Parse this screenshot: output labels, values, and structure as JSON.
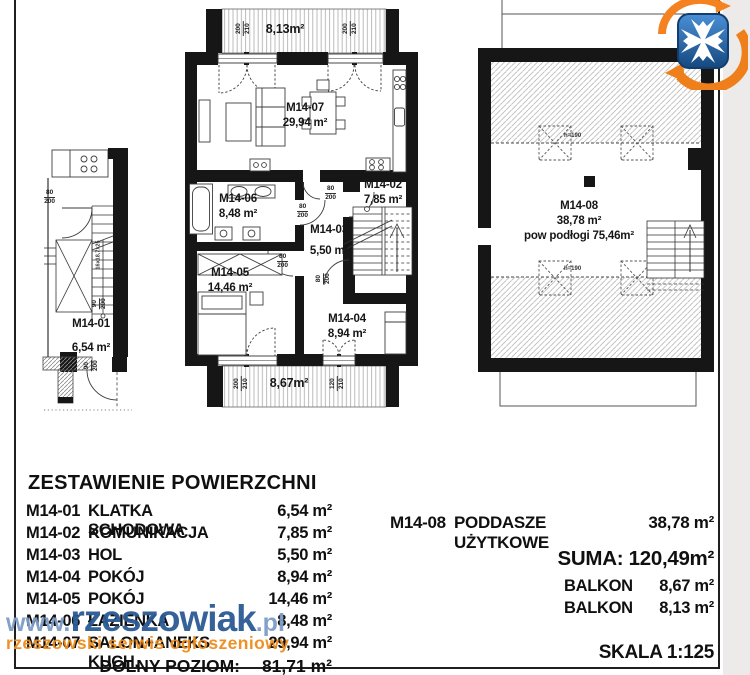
{
  "watermark": {
    "prefix": "www.",
    "brand": "rzeszowiak",
    "suffix": ".pl",
    "tagline": "rzeszowski serwis ogłoszeniowy"
  },
  "plan_lower": {
    "balcony_top_area": "8,13m²",
    "balcony_bottom_area": "8,67m²",
    "rooms": [
      {
        "id": "M14-07",
        "area": "29,94 m²"
      },
      {
        "id": "M14-06",
        "area": "8,48 m²"
      },
      {
        "id": "M14-02",
        "area": "7,85 m²"
      },
      {
        "id": "M14-03",
        "area": "5,50 m²"
      },
      {
        "id": "M14-05",
        "area": "14,46 m²"
      },
      {
        "id": "M14-04",
        "area": "8,94 m²"
      }
    ]
  },
  "plan_stair": {
    "id": "M14-01",
    "area": "6,54 m²",
    "stair_note": "16x18,7x25"
  },
  "plan_attic": {
    "id": "M14-08",
    "area": "38,78 m²",
    "floor_area": "pow podłogi 75,46m²",
    "height_label": "h=190"
  },
  "dims": {
    "door80": {
      "w": "80",
      "h": "200"
    },
    "door90": {
      "w": "90",
      "h": "200"
    },
    "win200": {
      "w": "200",
      "h": "210"
    },
    "win120": {
      "w": "120",
      "h": "210"
    }
  },
  "summary": {
    "title": "ZESTAWIENIE POWIERZCHNI",
    "rows": [
      {
        "code": "M14-01",
        "name": "KLATKA SCHODOWA",
        "area": "6,54 m²"
      },
      {
        "code": "M14-02",
        "name": "KOMUNIKACJA",
        "area": "7,85 m²"
      },
      {
        "code": "M14-03",
        "name": "HOL",
        "area": "5,50 m²"
      },
      {
        "code": "M14-04",
        "name": "POKÓJ",
        "area": "8,94 m²"
      },
      {
        "code": "M14-05",
        "name": "POKÓJ",
        "area": "14,46 m²"
      },
      {
        "code": "M14-06",
        "name": "ŁAZIENKA",
        "area": "8,48 m²"
      },
      {
        "code": "M14-07",
        "name": "SALON+ANEKS KUCH.",
        "area": "29,94 m²"
      }
    ],
    "total_label": "DOLNY POZIOM:",
    "total_area": "81,71 m²"
  },
  "summary_attic": {
    "row": {
      "code": "M14-08",
      "name": "PODDASZE UŻYTKOWE",
      "area": "38,78 m²"
    },
    "suma_label": "SUMA:",
    "suma_value": "120,49m²",
    "balcony_rows": [
      {
        "label": "BALKON",
        "area": "8,67 m²"
      },
      {
        "label": "BALKON",
        "area": "8,13 m²"
      }
    ]
  },
  "scale_label": "SKALA 1:125"
}
